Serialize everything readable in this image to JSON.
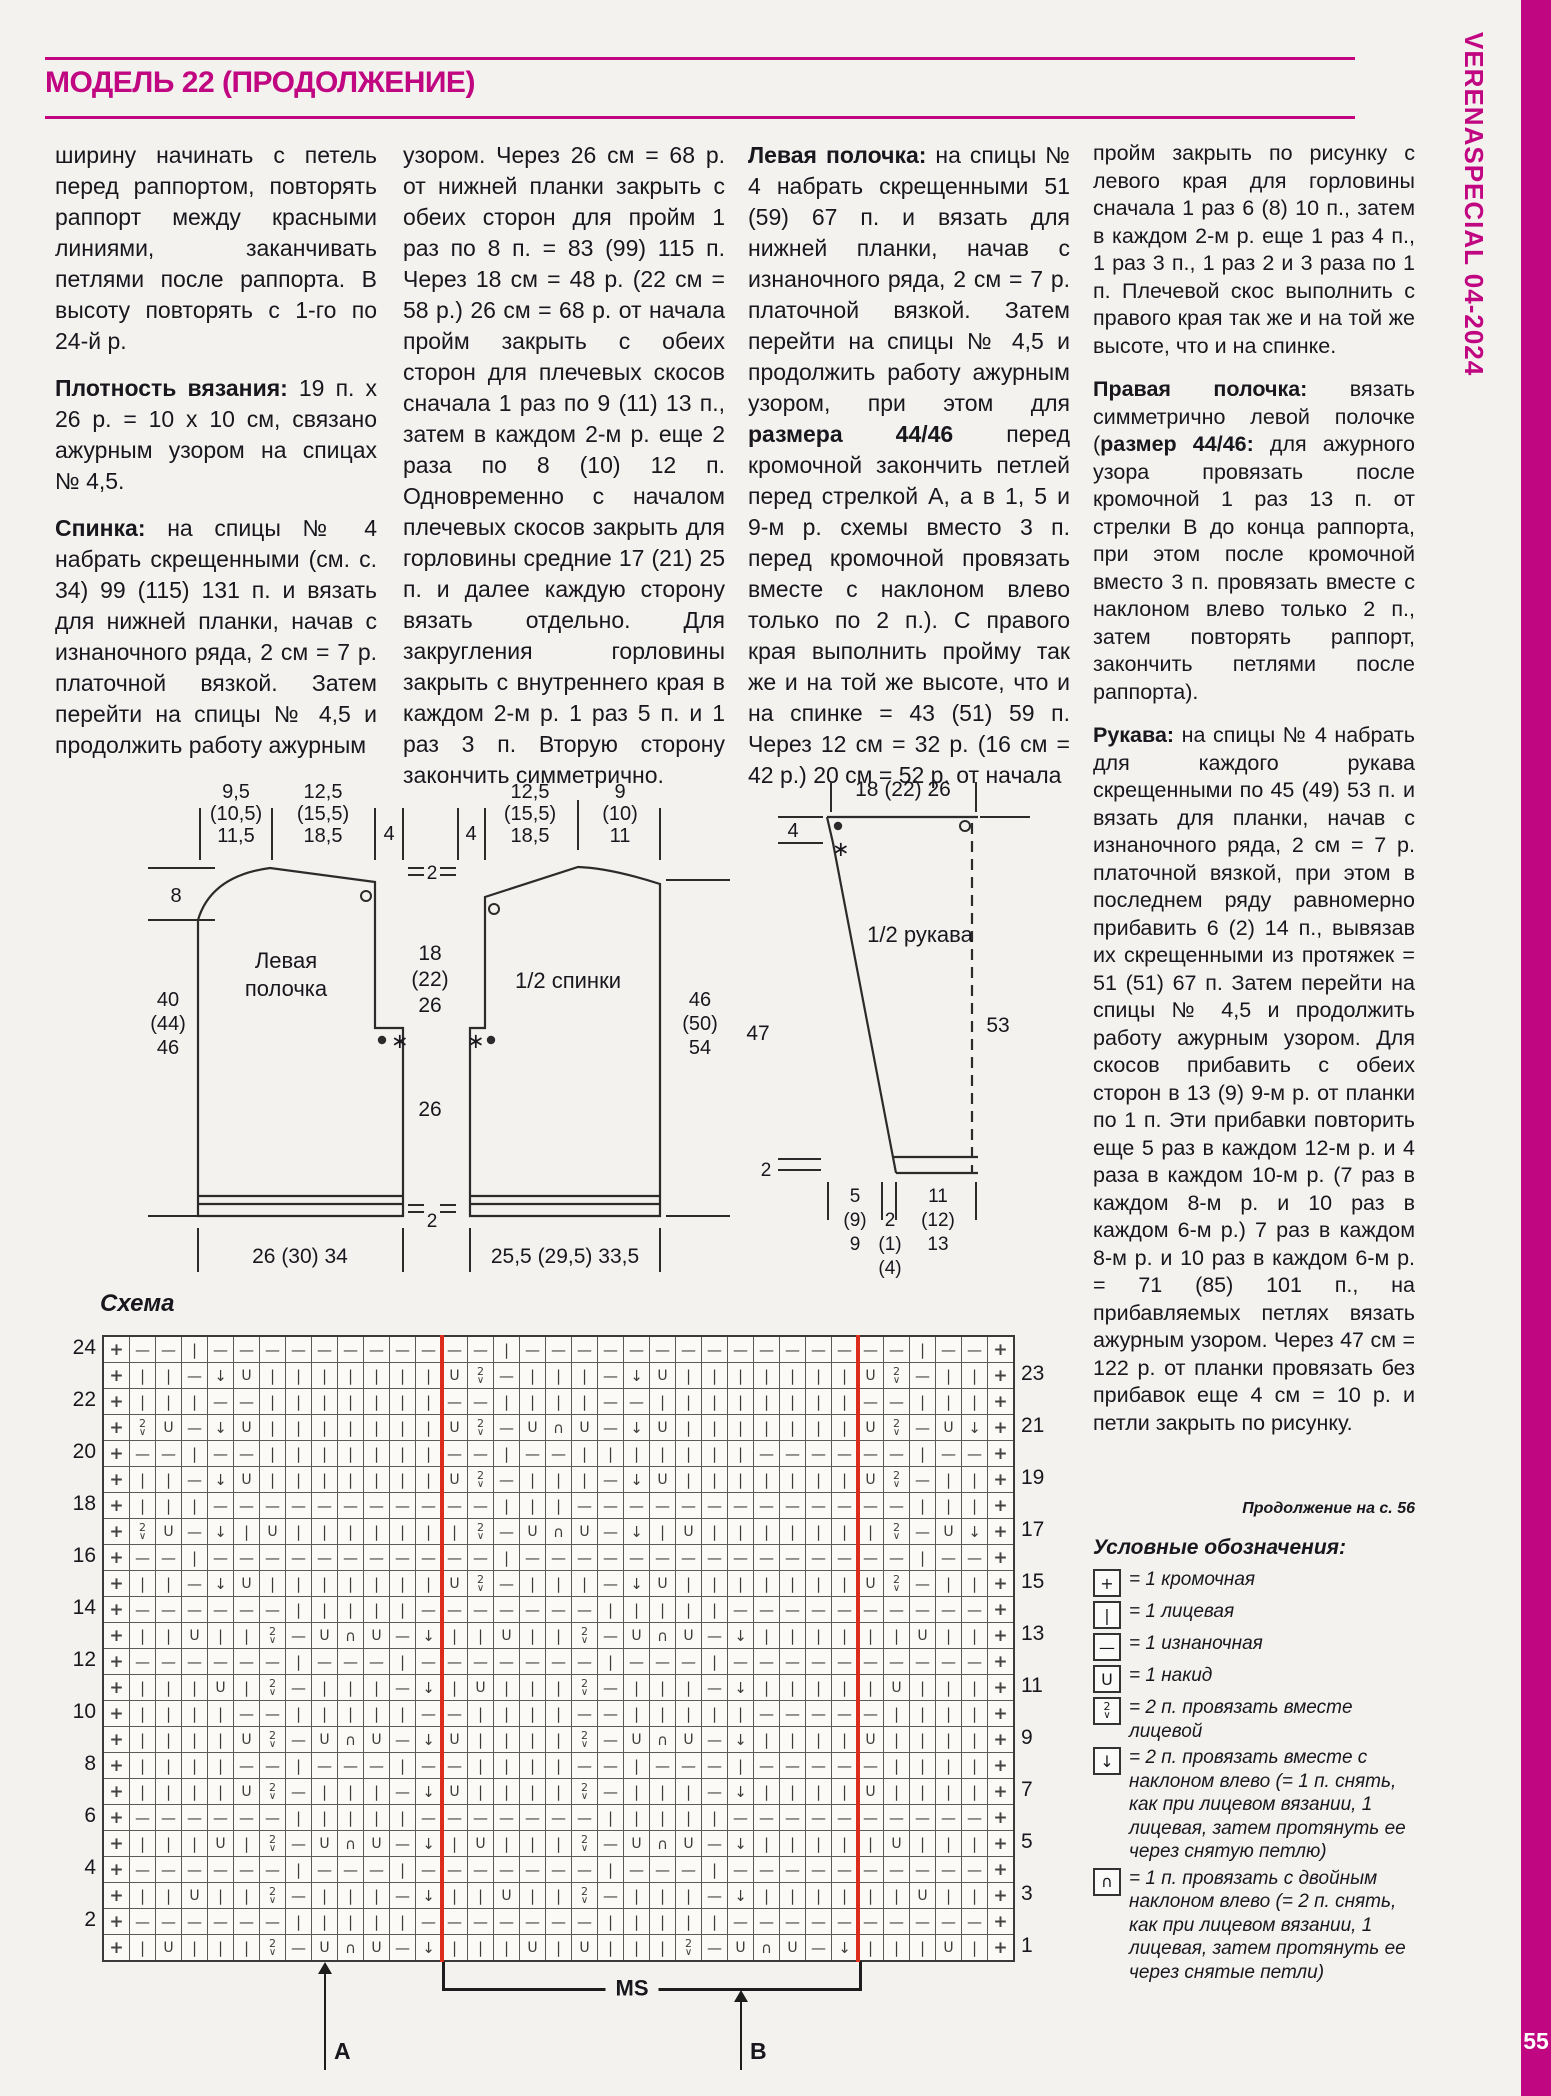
{
  "brand": {
    "magenta": "#c00680",
    "chart_red": "#dd2b1c",
    "sidebar_text": "VERENASPECIAL 04-2024",
    "page_number": "55"
  },
  "header": {
    "title": "МОДЕЛЬ 22 (ПРОДОЛЖЕНИЕ)"
  },
  "columns": [
    {
      "paragraphs": [
        {
          "lead": "",
          "text": "ширину начинать с петель перед раппортом, повторять раппорт между красными линиями, заканчивать петлями после раппорта. В высоту повторять с 1-го по 24-й р."
        },
        {
          "lead": "Плотность вязания:",
          "text": "19 п. х 26 р. = 10 х 10 см, связано ажурным узором на спицах № 4,5."
        },
        {
          "lead": "Спинка:",
          "text": "на спицы № 4 набрать скрещенными (см. с. 34) 99 (115) 131 п. и вязать для нижней планки, начав с изнаночного ряда, 2 см = 7 р. платочной вязкой. Затем перейти на спицы № 4,5 и продолжить работу ажурным"
        }
      ]
    },
    {
      "paragraphs": [
        {
          "lead": "",
          "text": "узором. Через 26 см = 68 р. от нижней планки закрыть с обеих сторон для пройм 1 раз по 8 п. = 83 (99) 115 п. Через 18 см = 48 р. (22 см = 58 р.) 26 см = 68 р. от начала пройм закрыть с обеих сторон для плечевых скосов сначала 1 раз по 9 (11) 13 п., затем в каждом 2-м р. еще 2 раза по 8 (10) 12 п. Одновременно с началом плечевых скосов закрыть для горловины средние 17 (21) 25 п. и далее каждую сторону вязать отдельно. Для закругления горловины закрыть с внутреннего края в каждом 2-м р. 1 раз 5 п. и 1 раз 3 п. Вторую сторону закончить симметрично."
        }
      ]
    },
    {
      "paragraphs": [
        {
          "lead": "Левая полочка:",
          "text": "на спицы № 4 набрать скрещенными 51 (59) 67 п. и вязать для нижней планки, начав с изнаночного ряда, 2 см = 7 р. платочной вязкой. Затем перейти на спицы № 4,5 и продолжить работу ажурным узором, при этом для **размера 44/46** перед кромочной закончить петлей перед стрелкой А, а в 1, 5 и 9-м р. схемы вместо 3 п. перед кромочной провязать вместе с наклоном влево только по 2 п.). С правого края выполнить пройму так же и на той же высоте, что и на спинке = 43 (51) 59 п. Через 12 см = 32 р. (16 см = 42 р.) 20 см = 52 р. от начала"
        }
      ]
    },
    {
      "paragraphs": [
        {
          "lead": "",
          "text": "пройм закрыть по рисунку с левого края для горловины сначала 1 раз 6 (8) 10 п., затем в каждом 2-м р. еще 1 раз 4 п., 1 раз 3 п., 1 раз 2 и 3 раза по 1 п. Плечевой скос выполнить с правого края так же и на той же высоте, что и на спинке."
        },
        {
          "lead": "Правая полочка:",
          "text": "вязать симметрично левой полочке (**размер 44/46:** для ажурного узора провязать после кромочной 1 раз 13 п. от стрелки В до конца раппорта, при этом после кромочной вместо 3 п. провязать вместе с наклоном влево только 2 п., затем повторять раппорт, закончить петлями после раппорта)."
        },
        {
          "lead": "Рукава:",
          "text": "на спицы № 4 набрать для каждого рукава скрещенными по 45 (49) 53 п. и вязать для планки, начав с изнаночного ряда, 2 см = 7 р. платочной вязкой, при этом в последнем ряду равномерно прибавить 6 (2) 14 п., вывязав их скрещенными из протяжек = 51 (51) 67 п. Затем перейти на спицы № 4,5 и продолжить работу ажурным узором. Для скосов прибавить с обеих сторон в 13 (9) 9-м р. от планки по 1 п. Эти прибавки повторить еще 5 раз в каждом 12-м р. и 4 раза в каждом 10-м р. (7 раз в каждом 8-м р. и 10 раз в каждом 6-м р.) 7 раз в каждом 8-м р. и 10 раз в каждом 6-м р. = 71 (85) 101 п., на прибавляемых петлях вязать ажурным узором. Через 47 см = 122 р. от планки провязать без прибавок еще 4 см = 10 р. и петли закрыть по рисунку."
        }
      ]
    }
  ],
  "continuation_note": "Продолжение на с. 56",
  "diagram": {
    "schema_label": "Схема",
    "front": {
      "name": [
        "Левая",
        "полочка"
      ],
      "neck": [
        "9,5",
        "(10,5)",
        "11,5"
      ],
      "shoulder": [
        "12,5",
        "(15,5)",
        "18,5"
      ],
      "band": "4",
      "depth": "8",
      "side": [
        "40",
        "(44)",
        "46"
      ],
      "bottom": "26 (30) 34"
    },
    "gap": {
      "top": "2",
      "neckw": [
        "18",
        "(22)",
        "26"
      ],
      "len": "26",
      "bottom": "2"
    },
    "back": {
      "name": "1/2 спинки",
      "band": "4",
      "shoulder": [
        "12,5",
        "(15,5)",
        "18,5"
      ],
      "neck": [
        "9",
        "(10)",
        "11"
      ],
      "side": [
        "46",
        "(50)",
        "54"
      ],
      "bottom": "25,5 (29,5) 33,5"
    },
    "sleeve": {
      "name": "1/2 рукава",
      "top": "18 (22) 26",
      "band": "4",
      "cuff": "2",
      "left": "47",
      "right": "53",
      "w1": [
        "5",
        "(9)",
        "9"
      ],
      "w2": [
        "2",
        "(1)",
        "(4)"
      ],
      "w3": [
        "11",
        "(12)",
        "13"
      ]
    }
  },
  "chart": {
    "ms_label": "MS",
    "arrow_a": "A",
    "arrow_b": "B",
    "rapport_after_cols": [
      13,
      29
    ],
    "rows": [
      {
        "n": 24,
        "b": "--i---------",
        "m": "--i-------------",
        "a": "--i--"
      },
      {
        "n": 23,
        "b": "ii-vuiiiiiii",
        "m": "uz-iii-vuiiiiiii",
        "a": "uz-ii"
      },
      {
        "n": 22,
        "b": "iii--iiiiiii",
        "m": "--iiii--iiiiiiii",
        "a": "--iii"
      },
      {
        "n": 21,
        "b": "zu-vuiiiiiii",
        "m": "uz-unu-vuiiiiiii",
        "a": "uz-uv"
      },
      {
        "n": 20,
        "b": "--i--iiiiiii",
        "m": "--i--iiiiiii----",
        "a": "--i--"
      },
      {
        "n": 19,
        "b": "ii-vuiiiiiii",
        "m": "uz-iii-vuiiiiiii",
        "a": "uz-ii"
      },
      {
        "n": 18,
        "b": "iii---------",
        "m": "--iii-----------",
        "a": "--iii"
      },
      {
        "n": 17,
        "b": "zu-viuiiiiii",
        "m": "iz-unu-viuiiiiii",
        "a": "iz-uv"
      },
      {
        "n": 16,
        "b": "--i---------",
        "m": "--i-------------",
        "a": "--i--"
      },
      {
        "n": 15,
        "b": "ii-vuiiiiiii",
        "m": "uz-iii-vuiiiiiii",
        "a": "uz-ii"
      },
      {
        "n": 14,
        "b": "------iiiii-",
        "m": "------iiiii-----",
        "a": "-----"
      },
      {
        "n": 13,
        "b": "iiuiiz-unu-v",
        "m": "iiuiiz-unu-viiii",
        "a": "iiuii"
      },
      {
        "n": 12,
        "b": "------i---i-",
        "m": "------i---i-----",
        "a": "-----"
      },
      {
        "n": 11,
        "b": "iiiuiz-iii-v",
        "m": "iuiiiz-iii-viiii",
        "a": "iuiii"
      },
      {
        "n": 10,
        "b": "iiii--iiiii-",
        "m": "-iiii--iiiii----",
        "a": "-iiii"
      },
      {
        "n": 9,
        "b": "iiiiuz-unu-v",
        "m": "uiiiiz-unu-viiii",
        "a": "uiiii"
      },
      {
        "n": 8,
        "b": "iiii--i---i-",
        "m": "-iiii--i---i----",
        "a": "-iiii"
      },
      {
        "n": 7,
        "b": "iiiiuz-iii-v",
        "m": "uiiiiz-iii-viiii",
        "a": "uiiii"
      },
      {
        "n": 6,
        "b": "------iiiii-",
        "m": "------iiiii-----",
        "a": "-----"
      },
      {
        "n": 5,
        "b": "iiiuiz-unu-v",
        "m": "iuiiiz-unu-viiii",
        "a": "iuiii"
      },
      {
        "n": 4,
        "b": "------i---i-",
        "m": "------i---i-----",
        "a": "-----"
      },
      {
        "n": 3,
        "b": "iiuiiz-iii-v",
        "m": "iiuiiz-iii-viiii",
        "a": "iiuii"
      },
      {
        "n": 2,
        "b": "------iiiii-",
        "m": "------iiiii-----",
        "a": "-----"
      },
      {
        "n": 1,
        "b": "iuiiiz-unu-v",
        "m": "iiiuiuiiiz-unu-v",
        "a": "iiiui"
      }
    ]
  },
  "legend": {
    "title": "Условные обозначения:",
    "items": [
      {
        "sym": "+",
        "text": "= 1 кромочная"
      },
      {
        "sym": "i",
        "text": "= 1 лицевая"
      },
      {
        "sym": "-",
        "text": "= 1 изнаночная"
      },
      {
        "sym": "u",
        "text": "= 1 накид"
      },
      {
        "sym": "z",
        "text": "= 2 п. провязать вместе лицевой"
      },
      {
        "sym": "v",
        "text": "= 2 п. провязать вместе с наклоном влево (= 1 п. снять, как при лицевом вязании, 1 лицевая, затем протянуть ее через снятую петлю)"
      },
      {
        "sym": "n",
        "text": "= 1 п. провязать с двойным наклоном влево (= 2 п. снять, как при лицевом вязании, 1 лицевая, затем протянуть ее через снятые петли)"
      }
    ]
  }
}
